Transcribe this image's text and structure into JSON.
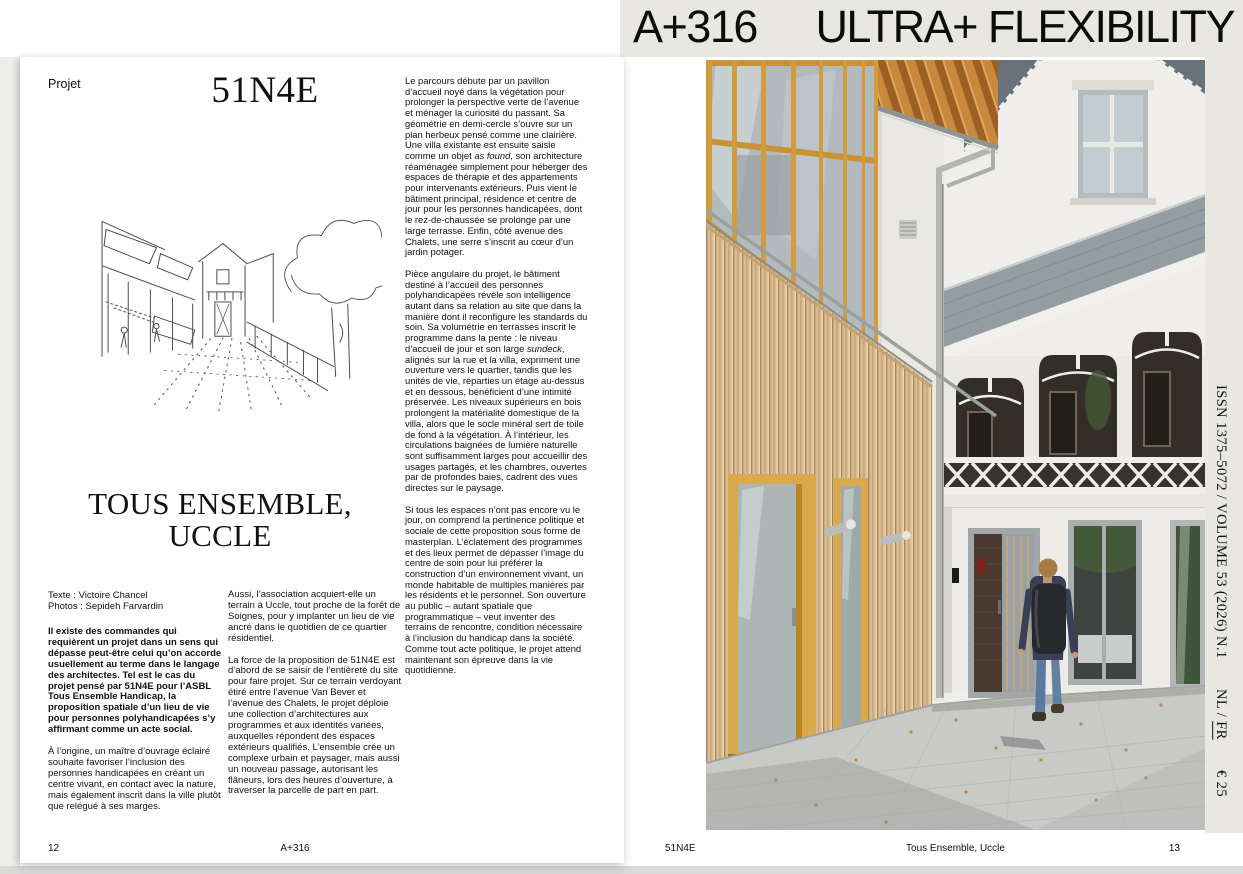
{
  "header": {
    "issue": "A+316",
    "theme": "ULTRA+ FLEXIBILITY"
  },
  "left_page": {
    "kicker": "Projet",
    "studio": "51N4E",
    "title": [
      "TOUS ENSEMBLE,",
      "UCCLE"
    ],
    "credits": {
      "text_line": "Texte : Victoire Chancel",
      "photos_line": "Photos : Sepideh Farvardin"
    },
    "col1": {
      "intro": "Il existe des commandes qui requièrent un projet dans un sens qui dépasse peut-être celui qu’on accorde usuellement au terme dans le langage des architectes. Tel est le cas du projet pensé par 51N4E pour l’ASBL Tous Ensemble Handicap, la proposition spatiale d’un lieu de vie pour personnes polyhandicapées s’y affirmant comme un acte social.",
      "para": "À l’origine, un maître d’ouvrage éclairé souhaite favoriser l’inclusion des personnes handicapées en créant un centre vivant, en contact avec la nature, mais également inscrit dans la ville plutôt que relégué à ses marges."
    },
    "col2": {
      "para1": "Aussi, l’association acquiert-elle un terrain à Uccle, tout proche de la forêt de Soignes, pour y implanter un lieu de vie ancré dans le quotidien de ce quartier résidentiel.",
      "para2": "La force de la proposition de 51N4E est d’abord de se saisir de l’entièreté du site pour faire projet. Sur ce terrain verdoyant étiré entre l’avenue Van Bever et l’avenue des Chalets, le projet déploie une collection d’architectures aux programmes et aux identités variées, auxquelles répondent des espaces extérieurs qualifiés. L’ensemble crée un complexe urbain et paysager, mais aussi un nouveau passage, autorisant les flâneurs, lors des heures d’ouverture, à traverser la parcelle de part en part."
    },
    "col3": {
      "para1": "Le parcours débute par un pavillon d’accueil noyé dans la végétation pour prolonger la perspective verte de l’avenue et ménager la curiosité du passant. Sa géométrie en demi-cercle s’ouvre sur un plan herbeux pensé comme une clairière. Une villa existante est ensuite saisie comme un objet *as found*, son architecture réaménagée simplement pour héberger des espaces de thérapie et des appartements pour intervenants extérieurs. Puis vient le bâtiment principal, résidence et centre de jour pour les personnes handicapées, dont le rez-de-chaussée se prolonge par une large terrasse. Enfin, côté avenue des Chalets, une serre s’inscrit au cœur d’un jardin potager.",
      "para2": "Pièce angulaire du projet, le bâtiment destiné à l’accueil des personnes polyhandicapées révèle son intelligence autant dans sa relation au site que dans la manière dont il reconfigure les standards du soin. Sa volumétrie en terrasses inscrit le programme dans la pente : le niveau d’accueil de jour et son large *sundeck*, alignés sur la rue et la villa, expriment une ouverture vers le quartier, tandis que les unités de vie, réparties un étage au-dessus et en dessous, bénéficient d’une intimité préservée. Les niveaux supérieurs en bois prolongent la matérialité domestique de la villa, alors que le socle minéral sert de toile de fond à la végétation. À l’intérieur, les circulations baignées de lumière naturelle sont suffisamment larges pour accueillir des usages partagés, et les chambres, ouvertes par de profondes baies, cadrent des vues directes sur le paysage.",
      "para3": "Si tous les espaces n’ont pas encore vu le jour, on comprend la pertinence politique et sociale de cette proposition sous forme de masterplan. L’éclatement des programmes et des lieux permet de dépasser l’image du centre de soin pour lui préférer la construction d’un environnement vivant, un monde habitable de multiples manières par les résidents et le personnel. Son ouverture au public – autant spatiale que programmatique – veut inventer des terrains de rencontre, condition nécessaire à l’inclusion du handicap dans la société. Comme tout acte politique, le projet attend maintenant son épreuve dans la vie quotidienne."
    },
    "footer": {
      "page_number": "12",
      "running_title": "A+316"
    }
  },
  "right_page": {
    "footer": {
      "studio": "51N4E",
      "article_title": "Tous Ensemble, Uccle",
      "page_number": "13"
    },
    "spine": {
      "issn_volume": "ISSN 1375–5072 / VOLUME 53 (2026) N.1",
      "language_nl": "NL",
      "language_separator": " / ",
      "language_fr": "FR",
      "price": "€ 25"
    }
  },
  "colors": {
    "header_background": "#e8e7e2",
    "timber_frame": "#d29b3e",
    "timber_slats": "#d8bb90",
    "slate_roof": "#939da2",
    "pavement": "#c9c9c7"
  }
}
